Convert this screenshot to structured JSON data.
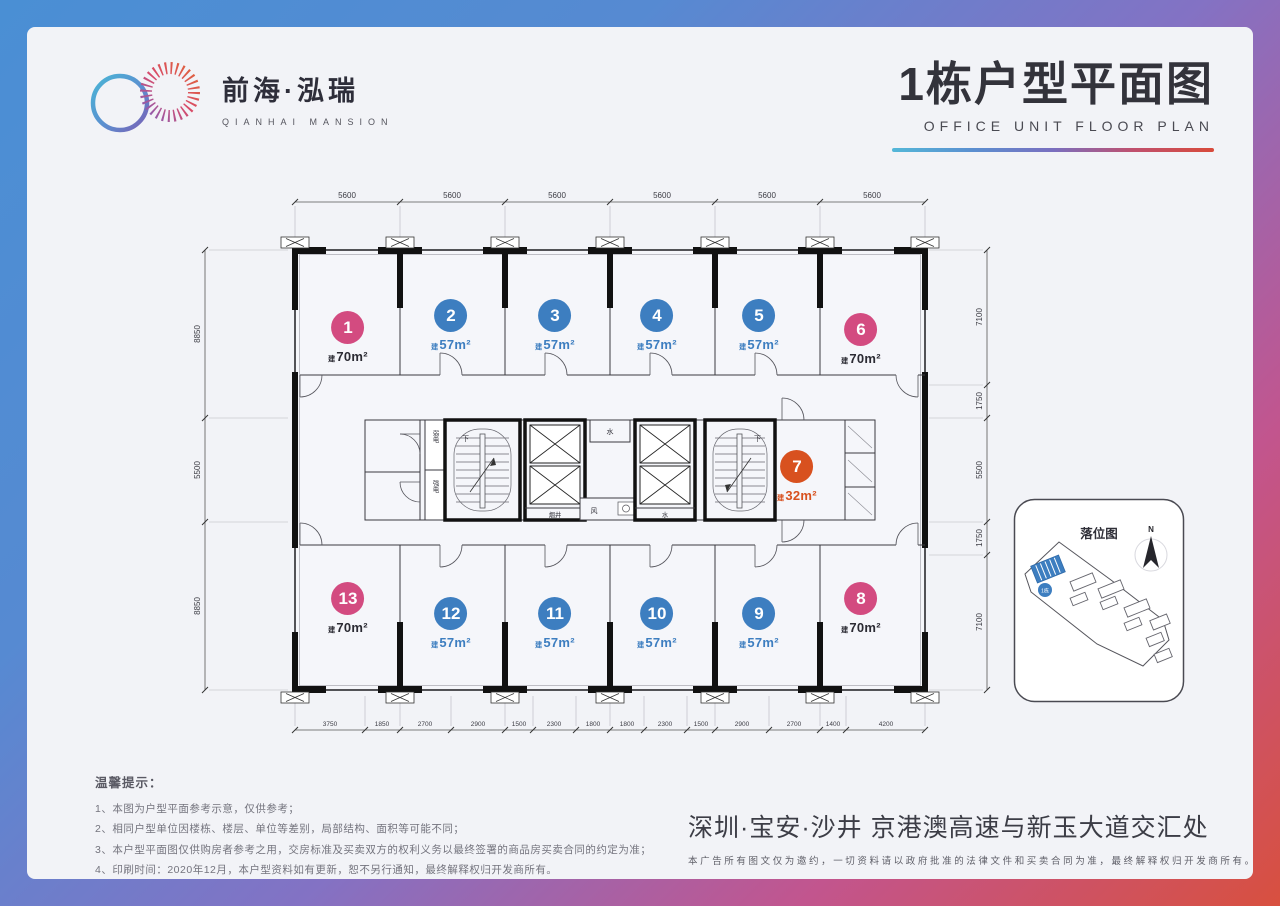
{
  "brand": {
    "logo_cn": "前海·泓瑞",
    "logo_en": "QIANHAI MANSION"
  },
  "header": {
    "title_cn": "1栋户型平面图",
    "title_en": "OFFICE UNIT FLOOR PLAN"
  },
  "plan": {
    "area_prefix": "建",
    "units": [
      {
        "no": "1",
        "area": "70m²",
        "color": "pink"
      },
      {
        "no": "2",
        "area": "57m²",
        "color": "blue"
      },
      {
        "no": "3",
        "area": "57m²",
        "color": "blue"
      },
      {
        "no": "4",
        "area": "57m²",
        "color": "blue"
      },
      {
        "no": "5",
        "area": "57m²",
        "color": "blue"
      },
      {
        "no": "6",
        "area": "70m²",
        "color": "pink"
      },
      {
        "no": "7",
        "area": "32m²",
        "color": "orange"
      },
      {
        "no": "8",
        "area": "70m²",
        "color": "pink"
      },
      {
        "no": "9",
        "area": "57m²",
        "color": "blue"
      },
      {
        "no": "10",
        "area": "57m²",
        "color": "blue"
      },
      {
        "no": "11",
        "area": "57m²",
        "color": "blue"
      },
      {
        "no": "12",
        "area": "57m²",
        "color": "blue"
      },
      {
        "no": "13",
        "area": "70m²",
        "color": "pink"
      }
    ],
    "rooms": {
      "stair_down_1": "下",
      "stair_down_2": "下",
      "weak_power": "弱电",
      "strong_power": "强电",
      "water_top": "水",
      "water_bottom": "水",
      "smoke_shaft": "烟井",
      "air": "风"
    },
    "dims_top": [
      "5600",
      "5600",
      "5600",
      "5600",
      "5600",
      "5600"
    ],
    "dims_bottom": [
      "3750",
      "1850",
      "2700",
      "2900",
      "1500",
      "2300",
      "1800",
      "1800",
      "2300",
      "1500",
      "2900",
      "2700",
      "1400",
      "4200"
    ],
    "dims_left": [
      "8850",
      "5500",
      "8850"
    ],
    "dims_right": [
      "7100",
      "1750",
      "5500",
      "1750",
      "7100"
    ]
  },
  "inset": {
    "title": "落位图",
    "north": "N",
    "building_label": "1栋"
  },
  "notes": {
    "title": "温馨提示：",
    "items": [
      "1、本图为户型平面参考示意，仅供参考；",
      "2、相同户型单位因楼栋、楼层、单位等差别，局部结构、面积等可能不同；",
      "3、本户型平面图仅供购房者参考之用，交房标准及买卖双方的权利义务以最终签署的商品房买卖合同的约定为准；",
      "4、印刷时间：2020年12月，本户型资料如有更新，恕不另行通知，最终解释权归开发商所有。"
    ]
  },
  "footer": {
    "slogan": "深圳·宝安·沙井 京港澳高速与新玉大道交汇处",
    "disclaimer": "本广告所有图文仅为邀约，一切资料请以政府批准的法律文件和买卖合同为准，最终解释权归开发商所有。"
  },
  "colors": {
    "unit_blue": "#3d7ec0",
    "unit_pink": "#d34b80",
    "unit_orange": "#d8511f"
  }
}
